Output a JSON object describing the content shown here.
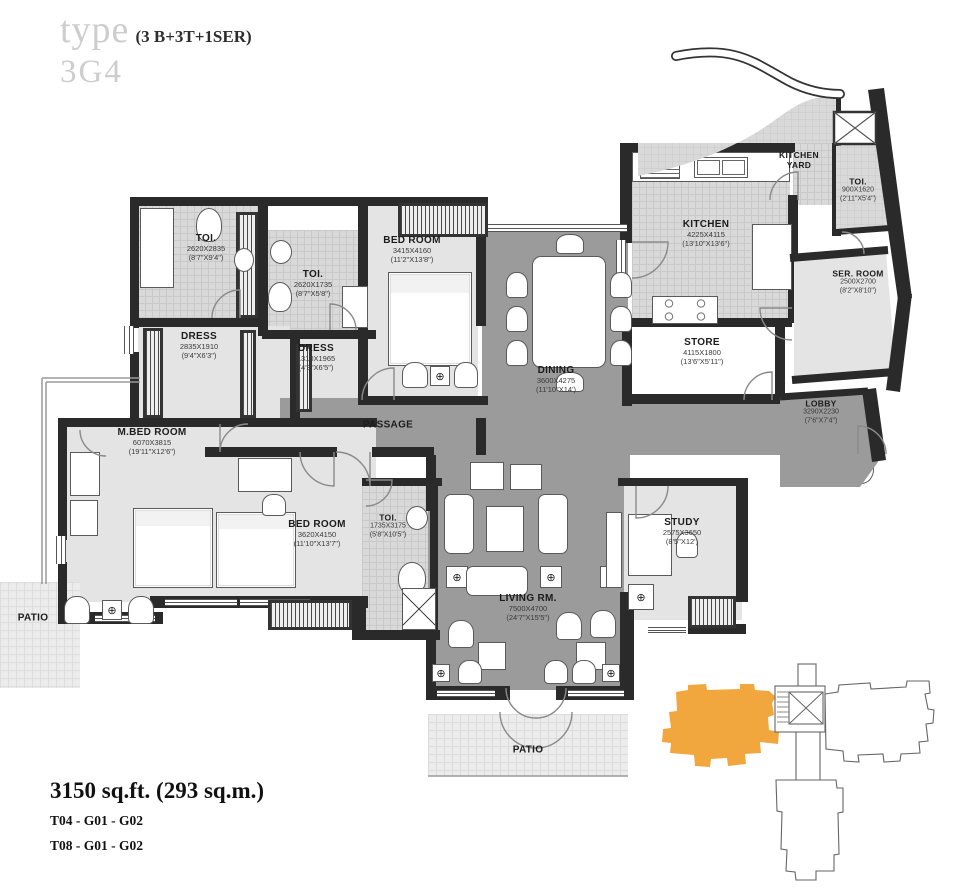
{
  "header": {
    "type_word": "type",
    "config": "(3 B+3T+1SER)",
    "unit_code": "3G4"
  },
  "footer": {
    "area": "3150 sq.ft. (293 sq.m.)",
    "towers": [
      "T04 - G01 - G02",
      "T08 - G01 - G02"
    ]
  },
  "rooms": {
    "toi1": {
      "name": "TOI.",
      "dims": "2620X2835",
      "imperial": "(8'7\"X9'4\")"
    },
    "toi2": {
      "name": "TOI.",
      "dims": "2620X1735",
      "imperial": "(8'7\"X5'8\")"
    },
    "dress1": {
      "name": "DRESS",
      "dims": "2835X1910",
      "imperial": "(9'4\"X6'3\")"
    },
    "dress2": {
      "name": "DRESS",
      "dims": "1310X1965",
      "imperial": "(4'3\"X6'5\")"
    },
    "bedroom_top": {
      "name": "BED ROOM",
      "dims": "3415X4160",
      "imperial": "(11'2\"X13'8\")"
    },
    "dining": {
      "name": "DINING",
      "dims": "3600X4275",
      "imperial": "(11'10\"X14')"
    },
    "kitchen": {
      "name": "KITCHEN",
      "dims": "4225X4115",
      "imperial": "(13'10\"X13'6\")"
    },
    "kitchen_yard": {
      "name": "KITCHEN YARD"
    },
    "toi3": {
      "name": "TOI.",
      "dims": "900X1620",
      "imperial": "(2'11\"X5'4\")"
    },
    "ser_room": {
      "name": "SER. ROOM",
      "dims": "2500X2700",
      "imperial": "(8'2\"X8'10\")"
    },
    "store": {
      "name": "STORE",
      "dims": "4115X1800",
      "imperial": "(13'6\"X5'11\")"
    },
    "lobby": {
      "name": "LOBBY",
      "dims": "3290X2230",
      "imperial": "(7'6\"X7'4\")"
    },
    "passage": {
      "name": "PASSAGE"
    },
    "mbedroom": {
      "name": "M.BED ROOM",
      "dims": "6070X3815",
      "imperial": "(19'11\"X12'6\")"
    },
    "bedroom2": {
      "name": "BED ROOM",
      "dims": "3620X4150",
      "imperial": "(11'10\"X13'7\")"
    },
    "toi4": {
      "name": "TOI.",
      "dims": "1735X3175",
      "imperial": "(5'8\"X10'5\")"
    },
    "living": {
      "name": "LIVING RM.",
      "dims": "7500X4700",
      "imperial": "(24'7\"X15'5\")"
    },
    "study": {
      "name": "STUDY",
      "dims": "2575X3650",
      "imperial": "(8'5\"X12')"
    },
    "patio_left": {
      "name": "PATIO"
    },
    "patio_bottom": {
      "name": "PATIO"
    }
  },
  "colors": {
    "keyplan_highlight": "#F2A73E",
    "circulation": "#9b9b9b",
    "room_fill": "#e4e4e4",
    "wet_area_tile": "#d9d9d9",
    "wall": "#2a2a2a"
  }
}
